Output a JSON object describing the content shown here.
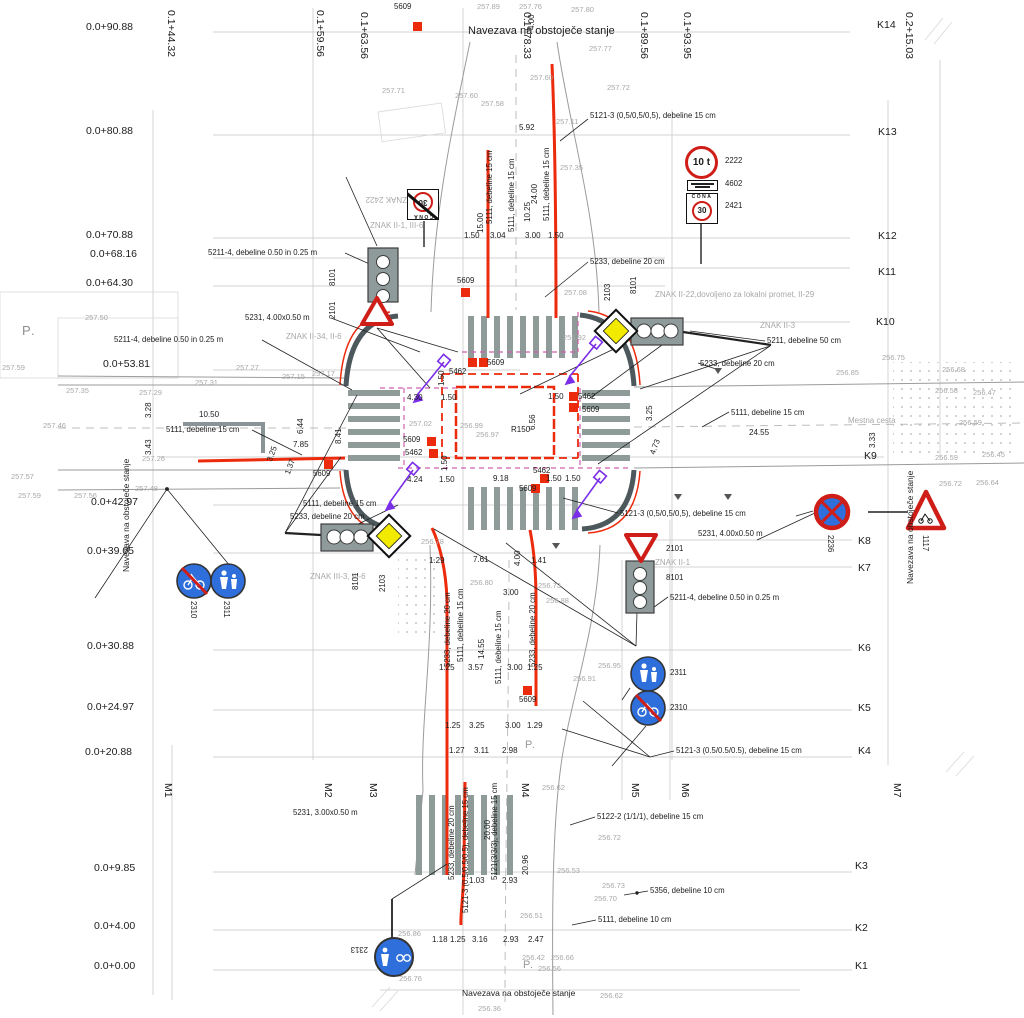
{
  "colors": {
    "red": "#ec2a0c",
    "magenta": "#cf5fae",
    "purple": "#7a2ee8",
    "yellow": "#f2ea00",
    "blue": "#2e6fdb",
    "sign_red": "#cf1d18",
    "curb": "#4c585c",
    "stripe": "#8e9b99",
    "grid": "#c4c4c4",
    "ink": "#1c1c1c",
    "muted": "#a8a8a8"
  },
  "signs": {
    "weight_limit": "10 t",
    "zone_word": "CONA",
    "zone_speed": "30"
  },
  "labels": [
    {
      "t": "0.0+90.88",
      "x": 86,
      "y": 22,
      "c": "k"
    },
    {
      "t": "0.0+80.88",
      "x": 86,
      "y": 126,
      "c": "k"
    },
    {
      "t": "0.0+70.88",
      "x": 86,
      "y": 230,
      "c": "k"
    },
    {
      "t": "0.0+68.16",
      "x": 90,
      "y": 249,
      "c": "k"
    },
    {
      "t": "0.0+64.30",
      "x": 86,
      "y": 278,
      "c": "k"
    },
    {
      "t": "0.0+53.81",
      "x": 103,
      "y": 359,
      "c": "k"
    },
    {
      "t": "0.0+42.97",
      "x": 91,
      "y": 497,
      "c": "k"
    },
    {
      "t": "0.0+39.05",
      "x": 87,
      "y": 546,
      "c": "k"
    },
    {
      "t": "0.0+30.88",
      "x": 87,
      "y": 641,
      "c": "k"
    },
    {
      "t": "0.0+24.97",
      "x": 87,
      "y": 702,
      "c": "k"
    },
    {
      "t": "0.0+20.88",
      "x": 85,
      "y": 747,
      "c": "k"
    },
    {
      "t": "0.0+9.85",
      "x": 94,
      "y": 863,
      "c": "k"
    },
    {
      "t": "0.0+4.00",
      "x": 94,
      "y": 921,
      "c": "k"
    },
    {
      "t": "0.0+0.00",
      "x": 94,
      "y": 961,
      "c": "k"
    },
    {
      "t": "0.1+44.32",
      "x": 176,
      "y": 10,
      "r": 90,
      "c": "k"
    },
    {
      "t": "0.1+59.56",
      "x": 325,
      "y": 10,
      "r": 90,
      "c": "k"
    },
    {
      "t": "0.1+63.56",
      "x": 369,
      "y": 12,
      "r": 90,
      "c": "k"
    },
    {
      "t": "0.1+78.33",
      "x": 532,
      "y": 12,
      "r": 90,
      "c": "k"
    },
    {
      "t": "0.1+89.56",
      "x": 649,
      "y": 12,
      "r": 90,
      "c": "k"
    },
    {
      "t": "0.1+93.95",
      "x": 692,
      "y": 12,
      "r": 90,
      "c": "k"
    },
    {
      "t": "0.2+15.03",
      "x": 914,
      "y": 12,
      "r": 90,
      "c": "k"
    },
    {
      "t": "K14",
      "x": 877,
      "y": 20,
      "c": "k"
    },
    {
      "t": "K13",
      "x": 878,
      "y": 127,
      "c": "k"
    },
    {
      "t": "K12",
      "x": 878,
      "y": 231,
      "c": "k"
    },
    {
      "t": "K11",
      "x": 878,
      "y": 267,
      "c": "k"
    },
    {
      "t": "K10",
      "x": 876,
      "y": 317,
      "c": "k"
    },
    {
      "t": "K9",
      "x": 864,
      "y": 451,
      "c": "k"
    },
    {
      "t": "K8",
      "x": 858,
      "y": 536,
      "c": "k"
    },
    {
      "t": "K7",
      "x": 858,
      "y": 563,
      "c": "k"
    },
    {
      "t": "K6",
      "x": 858,
      "y": 643,
      "c": "k"
    },
    {
      "t": "K5",
      "x": 858,
      "y": 703,
      "c": "k"
    },
    {
      "t": "K4",
      "x": 858,
      "y": 746,
      "c": "k"
    },
    {
      "t": "K3",
      "x": 855,
      "y": 861,
      "c": "k"
    },
    {
      "t": "K2",
      "x": 855,
      "y": 923,
      "c": "k"
    },
    {
      "t": "K1",
      "x": 855,
      "y": 961,
      "c": "k"
    },
    {
      "t": "M1",
      "x": 173,
      "y": 783,
      "r": 90,
      "c": "k"
    },
    {
      "t": "M2",
      "x": 333,
      "y": 783,
      "r": 90,
      "c": "k"
    },
    {
      "t": "M3",
      "x": 378,
      "y": 783,
      "r": 90,
      "c": "k"
    },
    {
      "t": "M4",
      "x": 530,
      "y": 783,
      "r": 90,
      "c": "k"
    },
    {
      "t": "M5",
      "x": 640,
      "y": 783,
      "r": 90,
      "c": "k"
    },
    {
      "t": "M6",
      "x": 690,
      "y": 783,
      "r": 90,
      "c": "k"
    },
    {
      "t": "M7",
      "x": 902,
      "y": 783,
      "r": 90,
      "c": "k"
    },
    {
      "t": "P.",
      "x": 22,
      "y": 324,
      "c": "p"
    },
    {
      "t": "P.",
      "x": 525,
      "y": 740,
      "c": "p2"
    },
    {
      "t": "P.",
      "x": 523,
      "y": 960,
      "c": "p2"
    },
    {
      "t": "Navezava na obstoječe stanje",
      "x": 468,
      "y": 26,
      "c": "t"
    },
    {
      "t": "Navezava na obstoječe stanje",
      "x": 462,
      "y": 989,
      "c": "t2"
    },
    {
      "t": "Navezava na obstoječe stanje",
      "x": 122,
      "y": 572,
      "r": -90,
      "c": "t2"
    },
    {
      "t": "Navezava na obstoječe stanje",
      "x": 906,
      "y": 584,
      "r": -90,
      "c": "t2"
    },
    {
      "t": "ZNAK II-22,dovoljeno za lokalni promet, II-29",
      "x": 655,
      "y": 291,
      "c": "g2"
    },
    {
      "t": "ZNAK II-3",
      "x": 760,
      "y": 322,
      "c": "g2"
    },
    {
      "t": "ZNAK II-34, II-6",
      "x": 286,
      "y": 333,
      "c": "g2"
    },
    {
      "t": "ZNAK II-1, III-6",
      "x": 370,
      "y": 222,
      "c": "g2"
    },
    {
      "t": "ZNAK III-3, III-6",
      "x": 310,
      "y": 573,
      "c": "g2"
    },
    {
      "t": "ZNAK II-1",
      "x": 655,
      "y": 559,
      "c": "g2"
    },
    {
      "t": "ZNAK 2422",
      "x": 407,
      "y": 203,
      "r": 180,
      "c": "g2"
    },
    {
      "t": "Mestna cesta",
      "x": 848,
      "y": 417,
      "c": "g2"
    },
    {
      "t": "5211-4, debeline 0.50 in 0.25 m",
      "x": 208,
      "y": 249
    },
    {
      "t": "5231, 4.00x0.50 m",
      "x": 245,
      "y": 314
    },
    {
      "t": "5211-4, debeline 0.50 in 0.25 m",
      "x": 114,
      "y": 336
    },
    {
      "t": "5111, debeline 15 cm",
      "x": 166,
      "y": 426
    },
    {
      "t": "5111, debeline 15 cm",
      "x": 303,
      "y": 500
    },
    {
      "t": "5233, debeline 20 cm",
      "x": 290,
      "y": 513
    },
    {
      "t": "5231, 3.00x0.50 m",
      "x": 293,
      "y": 809
    },
    {
      "t": "5121-3 (0,5/0,5/0,5), debeline 15 cm",
      "x": 590,
      "y": 112
    },
    {
      "t": "5233, debeline 20 cm",
      "x": 590,
      "y": 258
    },
    {
      "t": "5211, debeline 50 cm",
      "x": 767,
      "y": 337
    },
    {
      "t": "5233, debeline 20 cm",
      "x": 700,
      "y": 360
    },
    {
      "t": "5111, debeline 15 cm",
      "x": 731,
      "y": 409
    },
    {
      "t": "5121-3 (0,5/0,5/0,5), debeline 15 cm",
      "x": 620,
      "y": 510
    },
    {
      "t": "5231, 4.00x0.50 m",
      "x": 698,
      "y": 530
    },
    {
      "t": "5211-4, debeline 0.50 in 0.25 m",
      "x": 670,
      "y": 594
    },
    {
      "t": "5121-3 (0.5/0.5/0.5), debeline 15 cm",
      "x": 676,
      "y": 747
    },
    {
      "t": "5122-2 (1/1/1), debeline 15 cm",
      "x": 597,
      "y": 813
    },
    {
      "t": "5356, debeline 10 cm",
      "x": 650,
      "y": 887
    },
    {
      "t": "5111, debeline 10 cm",
      "x": 598,
      "y": 916
    },
    {
      "t": "2222",
      "x": 725,
      "y": 157
    },
    {
      "t": "4602",
      "x": 725,
      "y": 180
    },
    {
      "t": "2421",
      "x": 725,
      "y": 202
    },
    {
      "t": "2311",
      "x": 670,
      "y": 669
    },
    {
      "t": "2310",
      "x": 670,
      "y": 704
    },
    {
      "t": "2101",
      "x": 666,
      "y": 545
    },
    {
      "t": "8101",
      "x": 666,
      "y": 574
    },
    {
      "t": "2236",
      "x": 834,
      "y": 535,
      "r": 90
    },
    {
      "t": "1117",
      "x": 929,
      "y": 535,
      "r": 90
    },
    {
      "t": "2310",
      "x": 197,
      "y": 601,
      "r": 90
    },
    {
      "t": "2311",
      "x": 230,
      "y": 601,
      "r": 90
    },
    {
      "t": "2313",
      "x": 368,
      "y": 953,
      "r": 180
    },
    {
      "t": "8101",
      "x": 329,
      "y": 286,
      "r": -90
    },
    {
      "t": "2101",
      "x": 329,
      "y": 319,
      "r": -90
    },
    {
      "t": "2103",
      "x": 604,
      "y": 301,
      "r": -90
    },
    {
      "t": "8101",
      "x": 630,
      "y": 294,
      "r": -90
    },
    {
      "t": "8101",
      "x": 352,
      "y": 590,
      "r": -90
    },
    {
      "t": "2103",
      "x": 379,
      "y": 592,
      "r": -90
    },
    {
      "t": "5609",
      "x": 394,
      "y": 3
    },
    {
      "t": "5609",
      "x": 457,
      "y": 277
    },
    {
      "t": "5462",
      "x": 449,
      "y": 368
    },
    {
      "t": "5609",
      "x": 487,
      "y": 359
    },
    {
      "t": "5609",
      "x": 403,
      "y": 436
    },
    {
      "t": "5462",
      "x": 405,
      "y": 449
    },
    {
      "t": "5462",
      "x": 578,
      "y": 393
    },
    {
      "t": "5609",
      "x": 582,
      "y": 406
    },
    {
      "t": "5462",
      "x": 533,
      "y": 467
    },
    {
      "t": "5609",
      "x": 519,
      "y": 485
    },
    {
      "t": "5609",
      "x": 313,
      "y": 470
    },
    {
      "t": "5609",
      "x": 519,
      "y": 696
    },
    {
      "t": "5.92",
      "x": 519,
      "y": 124,
      "c": "d"
    },
    {
      "t": "1.50",
      "x": 464,
      "y": 232,
      "c": "d"
    },
    {
      "t": "3.04",
      "x": 490,
      "y": 232,
      "c": "d"
    },
    {
      "t": "3.00",
      "x": 525,
      "y": 232,
      "c": "d"
    },
    {
      "t": "1.50",
      "x": 548,
      "y": 232,
      "c": "d"
    },
    {
      "t": "4.30",
      "x": 407,
      "y": 394,
      "c": "d"
    },
    {
      "t": "1.50",
      "x": 441,
      "y": 394,
      "c": "d"
    },
    {
      "t": "1.50",
      "x": 548,
      "y": 393,
      "c": "d"
    },
    {
      "t": "R150",
      "x": 511,
      "y": 426,
      "c": "d"
    },
    {
      "t": "4.24",
      "x": 407,
      "y": 476,
      "c": "d"
    },
    {
      "t": "1.50",
      "x": 439,
      "y": 476,
      "c": "d"
    },
    {
      "t": "9.18",
      "x": 493,
      "y": 475,
      "c": "d"
    },
    {
      "t": "1.50",
      "x": 546,
      "y": 475,
      "c": "d"
    },
    {
      "t": "1.50",
      "x": 565,
      "y": 475,
      "c": "d"
    },
    {
      "t": "10.50",
      "x": 199,
      "y": 411,
      "c": "d"
    },
    {
      "t": "7.85",
      "x": 293,
      "y": 441,
      "c": "d"
    },
    {
      "t": "3.25",
      "x": 266,
      "y": 460,
      "r": -70,
      "c": "d"
    },
    {
      "t": "1.37",
      "x": 284,
      "y": 473,
      "r": -70,
      "c": "d"
    },
    {
      "t": "24.55",
      "x": 749,
      "y": 429,
      "c": "d"
    },
    {
      "t": "1.29",
      "x": 429,
      "y": 557,
      "c": "d"
    },
    {
      "t": "7.61",
      "x": 473,
      "y": 556,
      "c": "d"
    },
    {
      "t": "1.41",
      "x": 531,
      "y": 557,
      "c": "d"
    },
    {
      "t": "3.00",
      "x": 503,
      "y": 589,
      "c": "d"
    },
    {
      "t": "1.25",
      "x": 439,
      "y": 664,
      "c": "d"
    },
    {
      "t": "3.57",
      "x": 468,
      "y": 664,
      "c": "d"
    },
    {
      "t": "3.00",
      "x": 507,
      "y": 664,
      "c": "d"
    },
    {
      "t": "1.25",
      "x": 527,
      "y": 664,
      "c": "d"
    },
    {
      "t": "1.25",
      "x": 445,
      "y": 722,
      "c": "d"
    },
    {
      "t": "3.25",
      "x": 469,
      "y": 722,
      "c": "d"
    },
    {
      "t": "3.00",
      "x": 505,
      "y": 722,
      "c": "d"
    },
    {
      "t": "1.29",
      "x": 527,
      "y": 722,
      "c": "d"
    },
    {
      "t": "1.27",
      "x": 449,
      "y": 747,
      "c": "d"
    },
    {
      "t": "3.11",
      "x": 474,
      "y": 747,
      "c": "d"
    },
    {
      "t": "2.98",
      "x": 502,
      "y": 747,
      "c": "d"
    },
    {
      "t": "1.03",
      "x": 469,
      "y": 877,
      "c": "d"
    },
    {
      "t": "2.93",
      "x": 502,
      "y": 877,
      "c": "d"
    },
    {
      "t": "1.18",
      "x": 432,
      "y": 936,
      "c": "d"
    },
    {
      "t": "1.25",
      "x": 450,
      "y": 936,
      "c": "d"
    },
    {
      "t": "3.16",
      "x": 472,
      "y": 936,
      "c": "d"
    },
    {
      "t": "2.93",
      "x": 503,
      "y": 936,
      "c": "d"
    },
    {
      "t": "2.47",
      "x": 528,
      "y": 936,
      "c": "d"
    },
    {
      "t": "15.00",
      "x": 477,
      "y": 233,
      "r": -90,
      "c": "d"
    },
    {
      "t": "10.25",
      "x": 524,
      "y": 222,
      "r": -90,
      "c": "d"
    },
    {
      "t": "24.00",
      "x": 531,
      "y": 204,
      "r": -90,
      "c": "d"
    },
    {
      "t": "4.00",
      "x": 528,
      "y": 30,
      "r": -90,
      "c": "d"
    },
    {
      "t": "4.00",
      "x": 514,
      "y": 566,
      "r": -90,
      "c": "d"
    },
    {
      "t": "14.55",
      "x": 478,
      "y": 659,
      "r": -90,
      "c": "d"
    },
    {
      "t": "20.00",
      "x": 484,
      "y": 840,
      "r": -90,
      "c": "d"
    },
    {
      "t": "20.96",
      "x": 522,
      "y": 875,
      "r": -90,
      "c": "d"
    },
    {
      "t": "3.28",
      "x": 145,
      "y": 418,
      "r": -90,
      "c": "d"
    },
    {
      "t": "3.43",
      "x": 145,
      "y": 455,
      "r": -90,
      "c": "d"
    },
    {
      "t": "8.41",
      "x": 335,
      "y": 444,
      "r": -90,
      "c": "d"
    },
    {
      "t": "6.44",
      "x": 297,
      "y": 434,
      "r": -90,
      "c": "d"
    },
    {
      "t": "1.50",
      "x": 438,
      "y": 386,
      "r": -90,
      "c": "d"
    },
    {
      "t": "1.50",
      "x": 441,
      "y": 471,
      "r": -90,
      "c": "d"
    },
    {
      "t": "6.56",
      "x": 529,
      "y": 430,
      "r": -90,
      "c": "d"
    },
    {
      "t": "3.25",
      "x": 646,
      "y": 421,
      "r": -90,
      "c": "d"
    },
    {
      "t": "4.73",
      "x": 649,
      "y": 453,
      "r": -70,
      "c": "d"
    },
    {
      "t": "3.33",
      "x": 869,
      "y": 448,
      "r": -90,
      "c": "d"
    },
    {
      "t": "5111, debeline 15 cm",
      "x": 486,
      "y": 224,
      "r": -90
    },
    {
      "t": "5111, debeline 15 cm",
      "x": 508,
      "y": 232,
      "r": -90
    },
    {
      "t": "5111, debeline 15 cm",
      "x": 543,
      "y": 221,
      "r": -90
    },
    {
      "t": "5233, debeline 20 cm",
      "x": 444,
      "y": 667,
      "r": -90
    },
    {
      "t": "5111, debeline 15 cm",
      "x": 457,
      "y": 662,
      "r": -90
    },
    {
      "t": "5111, debeline 15 cm",
      "x": 495,
      "y": 684,
      "r": -90
    },
    {
      "t": "5233, debeline 20 cm",
      "x": 529,
      "y": 667,
      "r": -90
    },
    {
      "t": "5233, debeline 20 cm",
      "x": 448,
      "y": 880,
      "r": -90
    },
    {
      "t": "5121-3 (0.5/0.5/0.5), debeline 15 cm",
      "x": 462,
      "y": 913,
      "r": -90
    },
    {
      "t": "5121(3/3/3), debeline 15 cm",
      "x": 491,
      "y": 880,
      "r": -90
    },
    {
      "t": "257.89",
      "x": 477,
      "y": 3,
      "c": "g"
    },
    {
      "t": "257.76",
      "x": 519,
      "y": 3,
      "c": "g"
    },
    {
      "t": "257.80",
      "x": 571,
      "y": 6,
      "c": "g"
    },
    {
      "t": "257.77",
      "x": 589,
      "y": 45,
      "c": "g"
    },
    {
      "t": "257.72",
      "x": 607,
      "y": 84,
      "c": "g"
    },
    {
      "t": "257.71",
      "x": 382,
      "y": 87,
      "c": "g"
    },
    {
      "t": "257.60",
      "x": 455,
      "y": 92,
      "c": "g"
    },
    {
      "t": "257.58",
      "x": 481,
      "y": 100,
      "c": "g"
    },
    {
      "t": "257.60",
      "x": 530,
      "y": 74,
      "c": "g"
    },
    {
      "t": "257.11",
      "x": 556,
      "y": 118,
      "c": "g"
    },
    {
      "t": "257.35",
      "x": 560,
      "y": 164,
      "c": "g"
    },
    {
      "t": "257.50",
      "x": 85,
      "y": 314,
      "c": "g"
    },
    {
      "t": "257.59",
      "x": 2,
      "y": 364,
      "c": "g"
    },
    {
      "t": "257.35",
      "x": 66,
      "y": 387,
      "c": "g"
    },
    {
      "t": "257.29",
      "x": 139,
      "y": 389,
      "c": "g"
    },
    {
      "t": "257.31",
      "x": 195,
      "y": 379,
      "c": "g"
    },
    {
      "t": "257.46",
      "x": 43,
      "y": 422,
      "c": "g"
    },
    {
      "t": "257.57",
      "x": 11,
      "y": 473,
      "c": "g"
    },
    {
      "t": "257.59",
      "x": 18,
      "y": 492,
      "c": "g"
    },
    {
      "t": "257.56",
      "x": 74,
      "y": 492,
      "c": "g"
    },
    {
      "t": "257.48",
      "x": 135,
      "y": 485,
      "c": "g"
    },
    {
      "t": "257.26",
      "x": 142,
      "y": 455,
      "c": "g"
    },
    {
      "t": "257.27",
      "x": 236,
      "y": 364,
      "c": "g"
    },
    {
      "t": "257.15",
      "x": 282,
      "y": 373,
      "c": "g"
    },
    {
      "t": "257.17",
      "x": 312,
      "y": 370,
      "c": "g"
    },
    {
      "t": "257.02",
      "x": 409,
      "y": 420,
      "c": "g"
    },
    {
      "t": "256.99",
      "x": 460,
      "y": 422,
      "c": "g"
    },
    {
      "t": "256.97",
      "x": 476,
      "y": 431,
      "c": "g"
    },
    {
      "t": "257.08",
      "x": 564,
      "y": 289,
      "c": "g"
    },
    {
      "t": "256.92",
      "x": 563,
      "y": 334,
      "c": "g"
    },
    {
      "t": "256.85",
      "x": 836,
      "y": 369,
      "c": "g"
    },
    {
      "t": "256.75",
      "x": 882,
      "y": 354,
      "c": "g"
    },
    {
      "t": "256.68",
      "x": 942,
      "y": 366,
      "c": "g"
    },
    {
      "t": "256.58",
      "x": 935,
      "y": 387,
      "c": "g"
    },
    {
      "t": "256.47",
      "x": 973,
      "y": 389,
      "c": "g"
    },
    {
      "t": "256.59",
      "x": 959,
      "y": 419,
      "c": "g"
    },
    {
      "t": "256.59",
      "x": 935,
      "y": 454,
      "c": "g"
    },
    {
      "t": "256.45",
      "x": 982,
      "y": 451,
      "c": "g"
    },
    {
      "t": "256.72",
      "x": 939,
      "y": 480,
      "c": "g"
    },
    {
      "t": "256.64",
      "x": 976,
      "y": 479,
      "c": "g"
    },
    {
      "t": "256.78",
      "x": 421,
      "y": 538,
      "c": "g"
    },
    {
      "t": "256.80",
      "x": 470,
      "y": 579,
      "c": "g"
    },
    {
      "t": "256.73",
      "x": 538,
      "y": 582,
      "c": "g"
    },
    {
      "t": "256.88",
      "x": 546,
      "y": 597,
      "c": "g"
    },
    {
      "t": "256.95",
      "x": 598,
      "y": 662,
      "c": "g"
    },
    {
      "t": "256.91",
      "x": 573,
      "y": 675,
      "c": "g"
    },
    {
      "t": "256.62",
      "x": 542,
      "y": 784,
      "c": "g"
    },
    {
      "t": "256.72",
      "x": 598,
      "y": 834,
      "c": "g"
    },
    {
      "t": "256.73",
      "x": 602,
      "y": 882,
      "c": "g"
    },
    {
      "t": "256.70",
      "x": 594,
      "y": 895,
      "c": "g"
    },
    {
      "t": "256.53",
      "x": 557,
      "y": 867,
      "c": "g"
    },
    {
      "t": "256.51",
      "x": 520,
      "y": 912,
      "c": "g"
    },
    {
      "t": "256.86",
      "x": 398,
      "y": 930,
      "c": "g"
    },
    {
      "t": "256.76",
      "x": 399,
      "y": 975,
      "c": "g"
    },
    {
      "t": "256.62",
      "x": 600,
      "y": 992,
      "c": "g"
    },
    {
      "t": "256.36",
      "x": 478,
      "y": 1005,
      "c": "g"
    },
    {
      "t": "256.42",
      "x": 522,
      "y": 954,
      "c": "g"
    },
    {
      "t": "256.66",
      "x": 551,
      "y": 954,
      "c": "g"
    },
    {
      "t": "256.56",
      "x": 538,
      "y": 965,
      "c": "g"
    }
  ]
}
